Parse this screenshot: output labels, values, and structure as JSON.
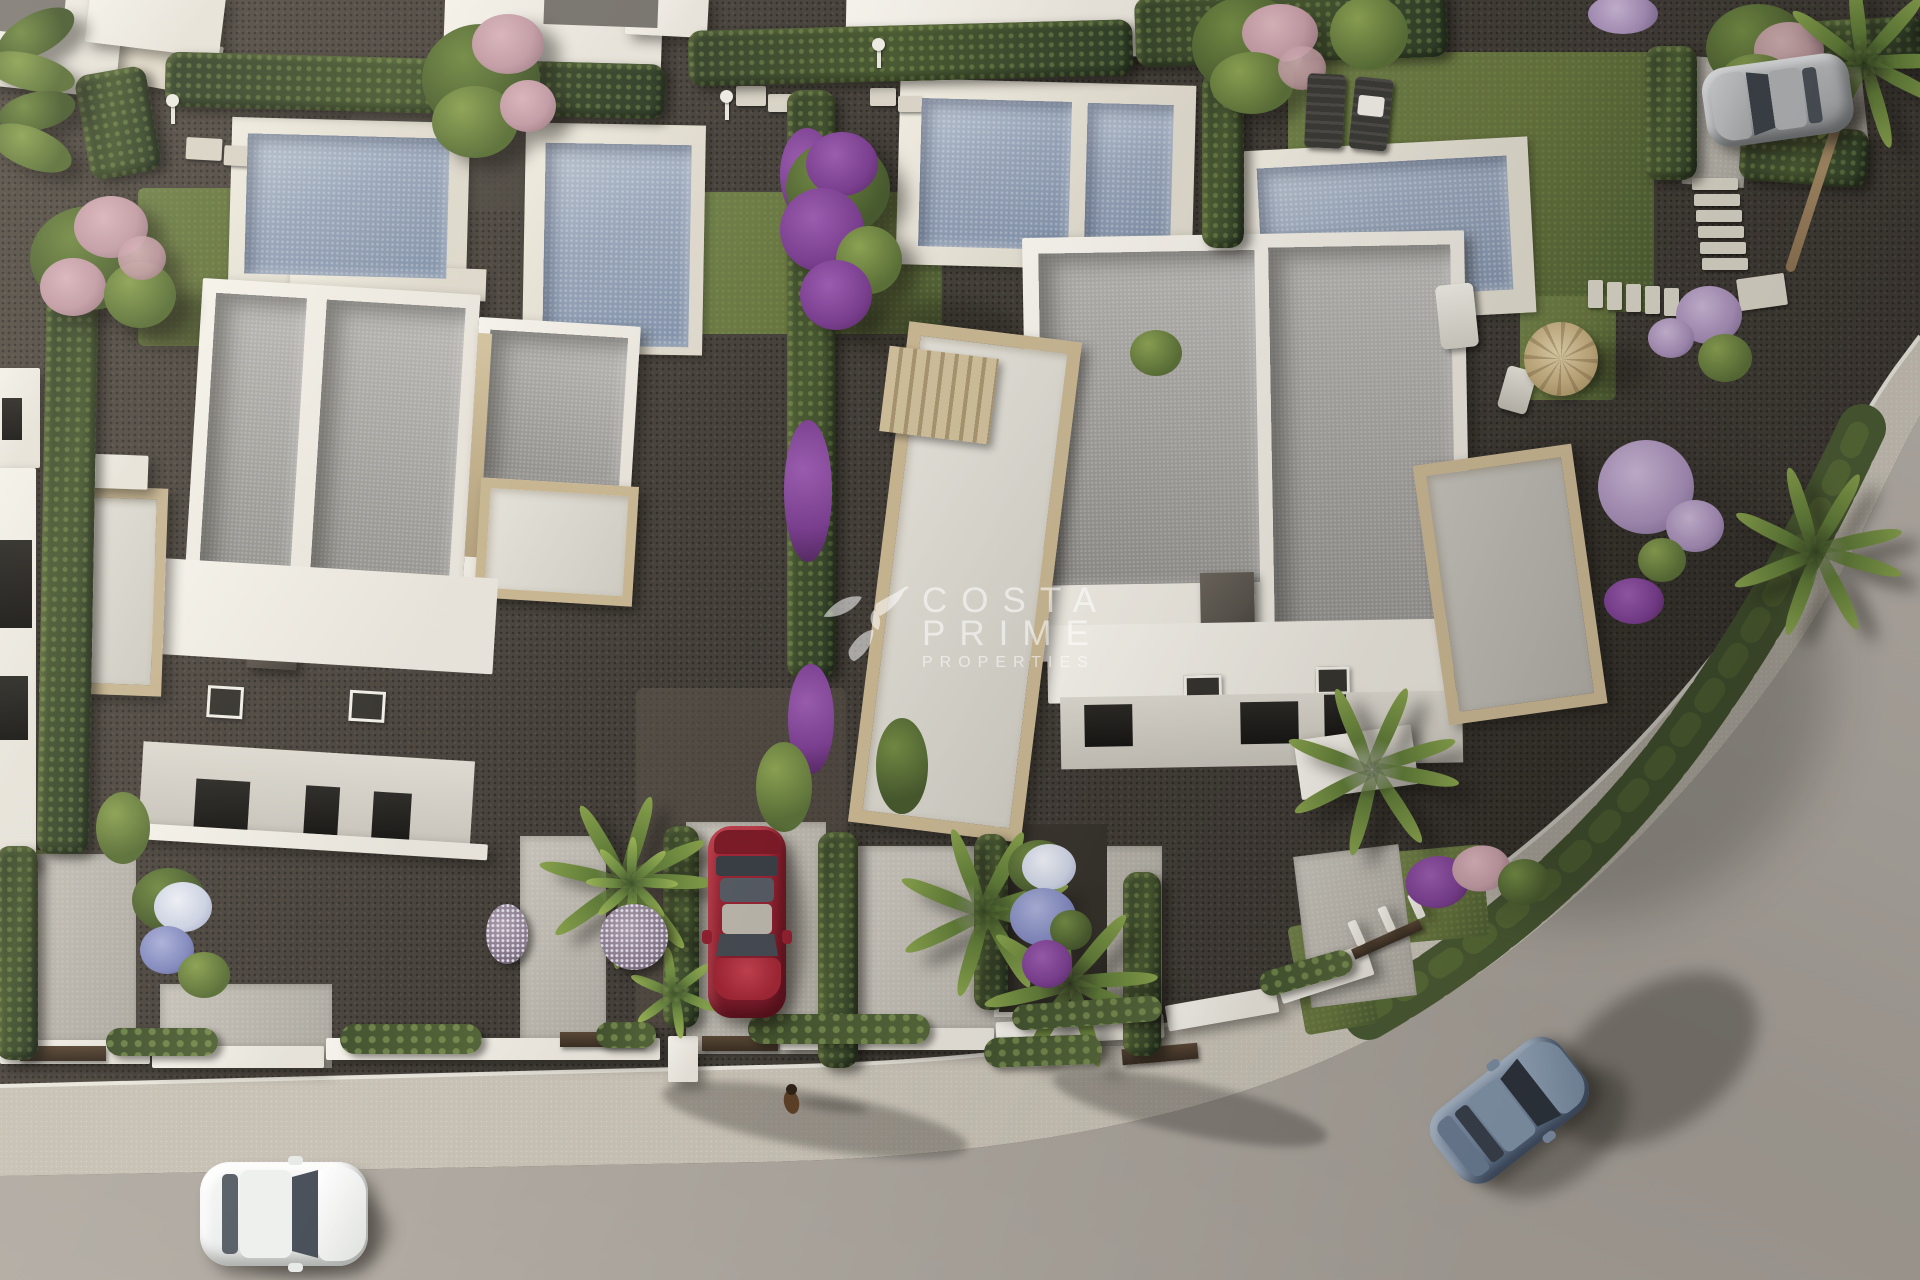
{
  "watermark": {
    "line1": "COSTA",
    "line2": "PRIME",
    "line3": "PROPERTIES",
    "logo": "hummingbird-icon",
    "opacity": 0.55
  },
  "scene": {
    "type": "aerial-3d-architectural-render",
    "subject": "Top-down render of two modern white flat-roof villas with private pools, travertine terraces, hedged gardens, parked cars and a curved street with sidewalk",
    "colors": {
      "gravel": "#45403a",
      "road": "#aca69e",
      "sidewalk": "#c7c1b5",
      "curb": "#e9e6dd",
      "lawn": "#66743e",
      "hedge": "#4a5a33",
      "water": "#97a4b8",
      "deck": "#ddd8cb",
      "wall": "#e6e2d9",
      "roof": "#a3a19d",
      "tan": "#c7b591",
      "chimney": "#59534c",
      "carred": "#8e2130",
      "carwhite": "#eef0ef",
      "carblue": "#72849c",
      "carsilver": "#a9abad",
      "purple": "#7b3f90",
      "pinkf": "#c29ba4",
      "wm": "#ffffff"
    }
  }
}
